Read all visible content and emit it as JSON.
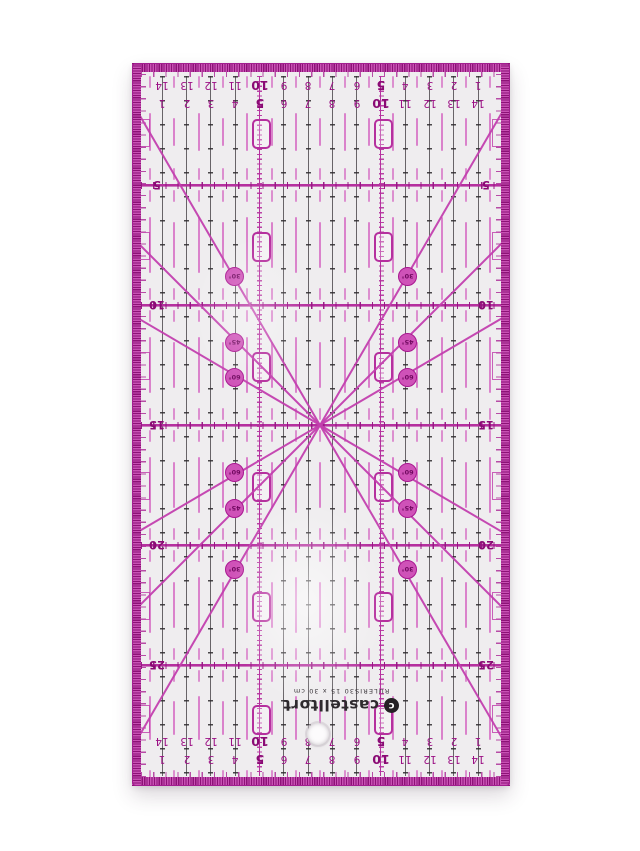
{
  "photo": {
    "background": "#ffffff",
    "subject": "transparent acrylic quilting ruler with magenta markings"
  },
  "brand": {
    "name": "castelltort",
    "logo_icon": "castelltort-logo",
    "spec": "RULERIS30 15 x 30 cm"
  },
  "scales": {
    "top_outer_row": [
      "14",
      "13",
      "12",
      "11",
      "10",
      "9",
      "8",
      "7",
      "6",
      "5",
      "4",
      "3",
      "2",
      "1"
    ],
    "top_inner_row": [
      "1",
      "2",
      "3",
      "4",
      "5",
      "6",
      "7",
      "8",
      "9",
      "10",
      "11",
      "12",
      "13",
      "14"
    ],
    "bottom_outer_row": [
      "14",
      "13",
      "12",
      "11",
      "10",
      "9",
      "8",
      "7",
      "6",
      "5",
      "4",
      "3",
      "2",
      "1"
    ],
    "bottom_inner_row": [
      "1",
      "2",
      "3",
      "4",
      "5",
      "6",
      "7",
      "8",
      "9",
      "10",
      "11",
      "12",
      "13",
      "14"
    ],
    "left_labels": [
      "5",
      "10",
      "15",
      "20",
      "25"
    ],
    "right_labels": [
      "5",
      "10",
      "15",
      "20",
      "25"
    ],
    "emphasized_values": [
      "5",
      "10"
    ]
  },
  "angle_markers": [
    {
      "label": "30°",
      "x": 92,
      "y": 203
    },
    {
      "label": "45°",
      "x": 92,
      "y": 269
    },
    {
      "label": "60°",
      "x": 92,
      "y": 304
    },
    {
      "label": "30°",
      "x": 265,
      "y": 203
    },
    {
      "label": "45°",
      "x": 265,
      "y": 269
    },
    {
      "label": "60°",
      "x": 265,
      "y": 304
    },
    {
      "label": "60°",
      "x": 92,
      "y": 399
    },
    {
      "label": "45°",
      "x": 92,
      "y": 435
    },
    {
      "label": "30°",
      "x": 92,
      "y": 496
    },
    {
      "label": "60°",
      "x": 265,
      "y": 399
    },
    {
      "label": "45°",
      "x": 265,
      "y": 435
    },
    {
      "label": "30°",
      "x": 265,
      "y": 496
    }
  ],
  "angle_lines_deg": [
    30.4,
    45,
    59.8,
    -30.4,
    -45,
    -59.8
  ],
  "colors": {
    "frame": "#c851b4",
    "frame_tick": "#8d1277",
    "outline": "#a21e90",
    "heavy_line": "#b5309e",
    "grid_line": "#4f4a4f",
    "dash": "#d66fc4",
    "number": "#9c1085",
    "number_strong": "#8a0a74",
    "circle_fill": "#cf52b8",
    "body": "#efedef"
  }
}
